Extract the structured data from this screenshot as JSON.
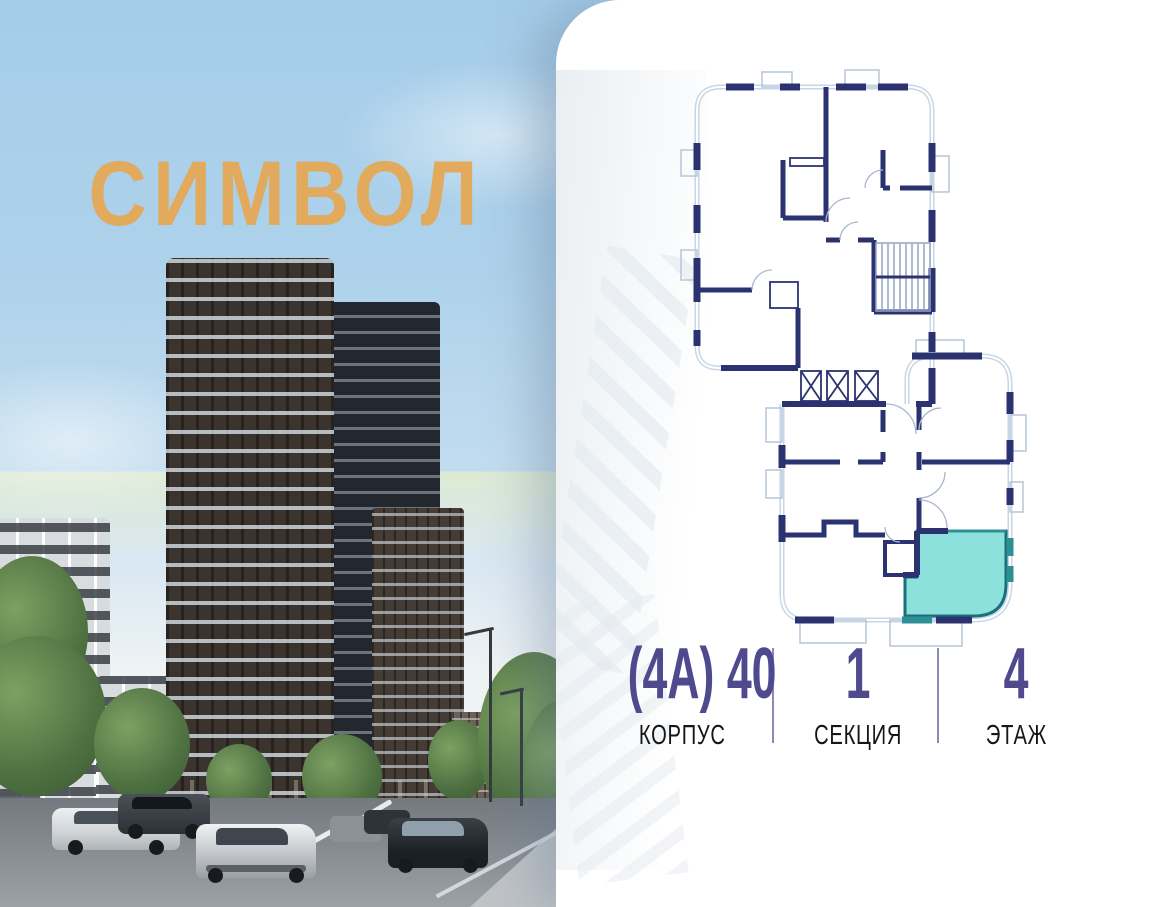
{
  "logo": {
    "text": "СИМВОЛ"
  },
  "unit_info": {
    "items": [
      {
        "value": "(4А) 40",
        "label": "КОРПУС"
      },
      {
        "value": "1",
        "label": "СЕКЦИЯ"
      },
      {
        "value": "4",
        "label": "ЭТАЖ"
      }
    ]
  },
  "colors": {
    "accent": "#4e4a8d",
    "label": "#15151a",
    "logo": "#e2aa5c",
    "wall": "#2b3270",
    "plan_outline": "#c6d6e6",
    "balcony": "#b7c6d8",
    "unit_fill": "#8ce1dc",
    "unit_border": "#1a7079",
    "unit_window": "#2e8f96"
  }
}
